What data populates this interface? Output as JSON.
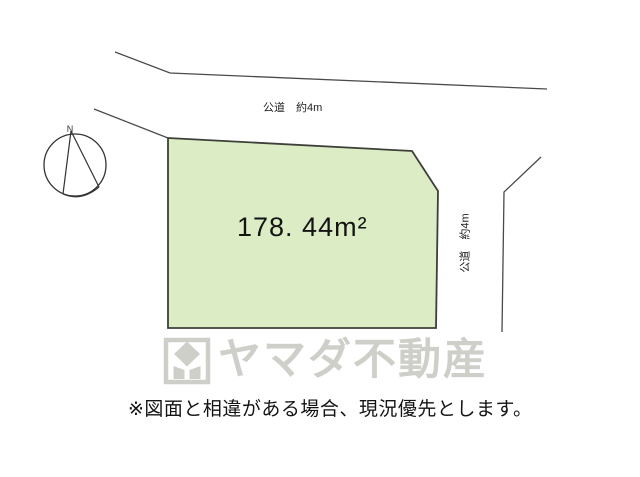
{
  "colors": {
    "background": "#ffffff",
    "parcel_fill": "#dcedc6",
    "parcel_stroke": "#3d4038",
    "road_line": "#4a4a4a",
    "watermark_gray": "#cfcfca",
    "text": "#141414"
  },
  "compass": {
    "north_label": "N"
  },
  "roads": {
    "top": {
      "label": "公道　約4m"
    },
    "right": {
      "label": "公道　約4m"
    }
  },
  "parcel": {
    "area_label": "178. 44m²"
  },
  "watermark": {
    "brand_text": "ヤマダ不動産"
  },
  "footer": {
    "disclaimer": "※図面と相違がある場合、現況優先とします。"
  }
}
